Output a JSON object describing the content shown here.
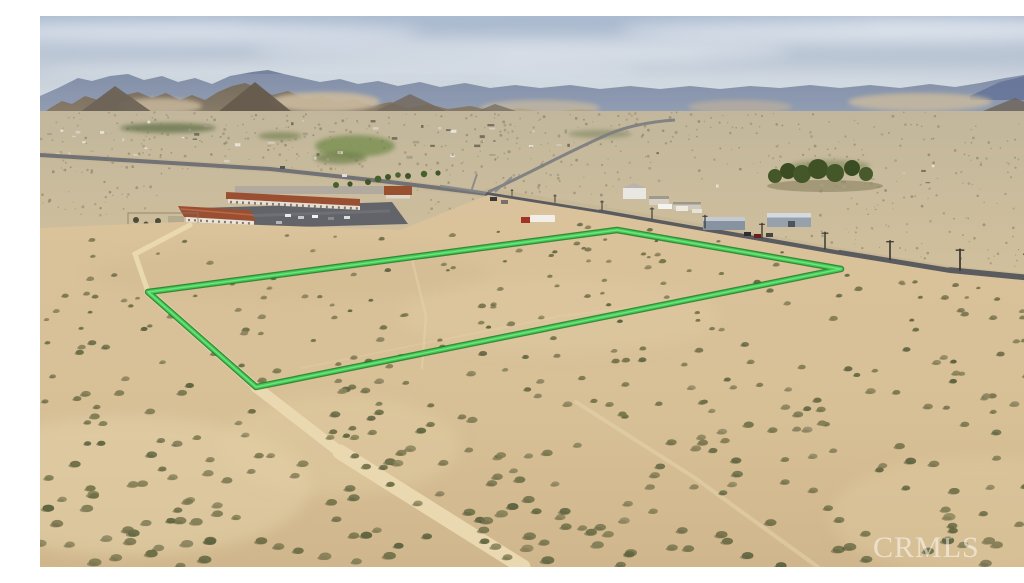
{
  "photo": {
    "description": "aerial-desert-vacant-land-listing-photo",
    "watermark": "CRMLS",
    "watermark_color": "rgba(255,255,255,0.52)"
  },
  "parcel_outline": {
    "corners_px": [
      [
        108,
        276
      ],
      [
        577,
        214
      ],
      [
        801,
        253
      ],
      [
        216,
        371
      ]
    ],
    "line_color": "#3ecb52",
    "edge_color": "#1f7a2c",
    "highlight_color": "#7fe88a"
  },
  "scene": {
    "sky_top": "#aebdd2",
    "sky_mid": "#c6cfda",
    "sky_horizon": "#e2e5e8",
    "mountain_far": "#75829e",
    "mountain_far_right": "#55648e",
    "mountain_near": "#786853",
    "mountain_near_dark": "#5e5040",
    "dune_sand": "#cbb592",
    "plain_top": "#c2b79c",
    "plain_bottom": "#d7c39c",
    "foreground_top": "#dac39c",
    "foreground_bottom": "#d0b68c",
    "road_asphalt": "#5a5b5f",
    "distant_road": "#717276",
    "dirt_road": "#ead8b0",
    "bush_dark": "#5f6540",
    "bush_olive": "#6f6f48",
    "bush_light": "#8c8560",
    "roof_terracotta": "#98512f",
    "motel_parking": "#62646a",
    "warehouse_blue": "#8793a0",
    "tree_green": "#445729",
    "field_green": "#7c9053",
    "town_speck_colors": [
      "#eceae4",
      "#d8d2c4",
      "#6a6254",
      "#a39a88"
    ]
  }
}
